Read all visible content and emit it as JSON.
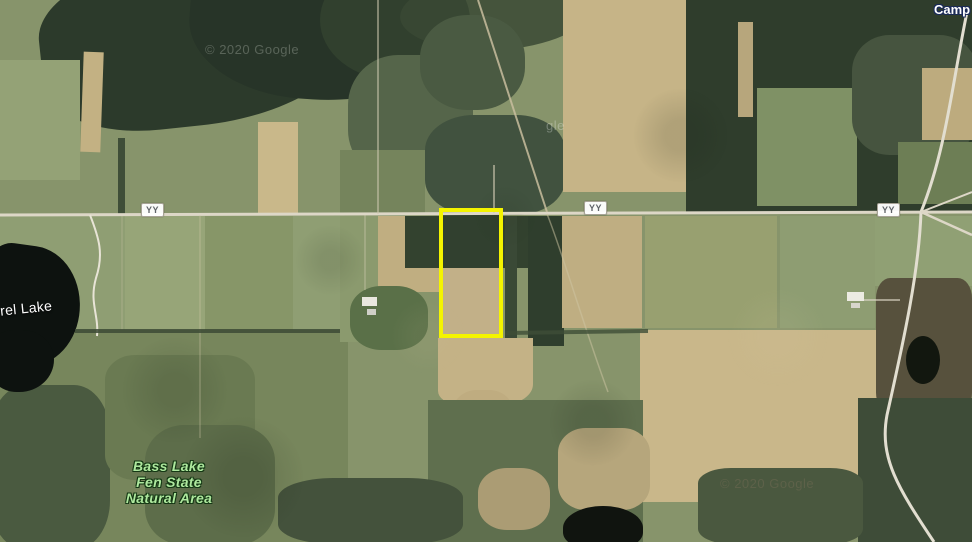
{
  "map": {
    "view_type": "satellite",
    "road_badges": [
      {
        "label": "YY"
      },
      {
        "label": "YY"
      },
      {
        "label": "YY"
      }
    ],
    "labels": {
      "lake_left": "rel Lake",
      "natural_area_line1": "Bass Lake",
      "natural_area_line2": "Fen State",
      "natural_area_line3": "Natural Area",
      "camp": "Camp"
    },
    "watermarks": {
      "top_left": "© 2020 Google",
      "center_fragment": "gle",
      "bottom_right": "© 2020 Google"
    },
    "parcel": {
      "highlight_color": "#f4f400"
    },
    "palette": {
      "field_green": "#8b9a6f",
      "field_tan": "#c3b183",
      "forest_dark": "#2f3d2c",
      "water": "#0d120f",
      "road": "#ddd7c7",
      "park_label_green": "#aee89e"
    }
  }
}
